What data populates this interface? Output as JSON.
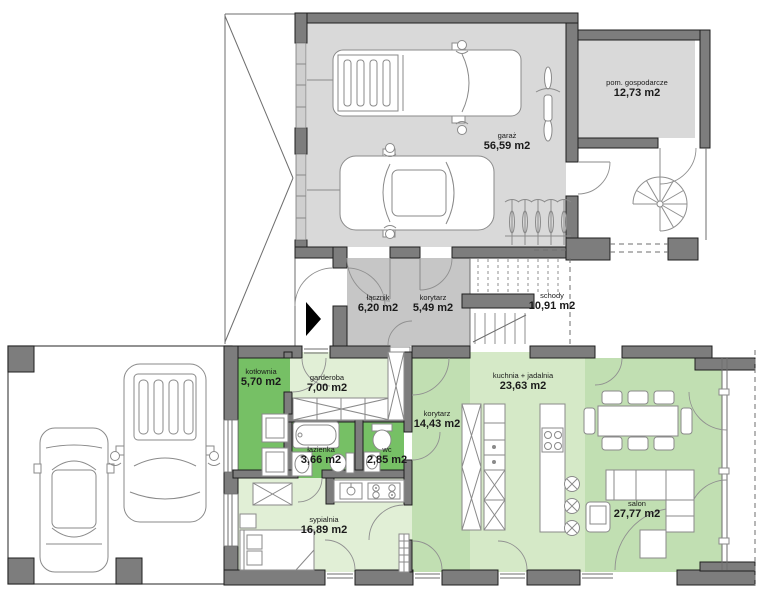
{
  "title": "Rzut parteru - plan domu",
  "colors": {
    "background": "#ffffff",
    "wall": "#7d7d7d",
    "wall_outline": "#1f1f1f",
    "garage_floor": "#d9d9d9",
    "hall_floor": "#c6c6c6",
    "garage_door": "#cfcfcf",
    "room_dark_green": "#76c065",
    "room_mid_green": "#c1dfb2",
    "room_light_green": "#d5e9c7",
    "room_pale_green": "#e1efd6",
    "furniture_stroke": "#8a8a8a",
    "label_text": "#1a1a1a"
  },
  "rooms": [
    {
      "id": "garaz",
      "name": "garaż",
      "area": "56,59 m2"
    },
    {
      "id": "pom-gospodarcze",
      "name": "pom. gospodarcze",
      "area": "12,73 m2"
    },
    {
      "id": "lacznik",
      "name": "łącznik",
      "area": "6,20 m2"
    },
    {
      "id": "korytarz-maly",
      "name": "korytarz",
      "area": "5,49 m2"
    },
    {
      "id": "schody",
      "name": "schody",
      "area": "10,91 m2"
    },
    {
      "id": "kotlownia",
      "name": "kotłownia",
      "area": "5,70 m2"
    },
    {
      "id": "garderoba",
      "name": "garderoba",
      "area": "7,00 m2"
    },
    {
      "id": "lazienka",
      "name": "łazienka",
      "area": "3,66 m2"
    },
    {
      "id": "wc",
      "name": "wc",
      "area": "2,85 m2"
    },
    {
      "id": "korytarz",
      "name": "korytarz",
      "area": "14,43 m2"
    },
    {
      "id": "kuchnia-jadalnia",
      "name": "kuchnia + jadalnia",
      "area": "23,63 m2"
    },
    {
      "id": "sypialnia",
      "name": "sypialnia",
      "area": "16,89 m2"
    },
    {
      "id": "salon",
      "name": "salon",
      "area": "27,77 m2"
    }
  ]
}
